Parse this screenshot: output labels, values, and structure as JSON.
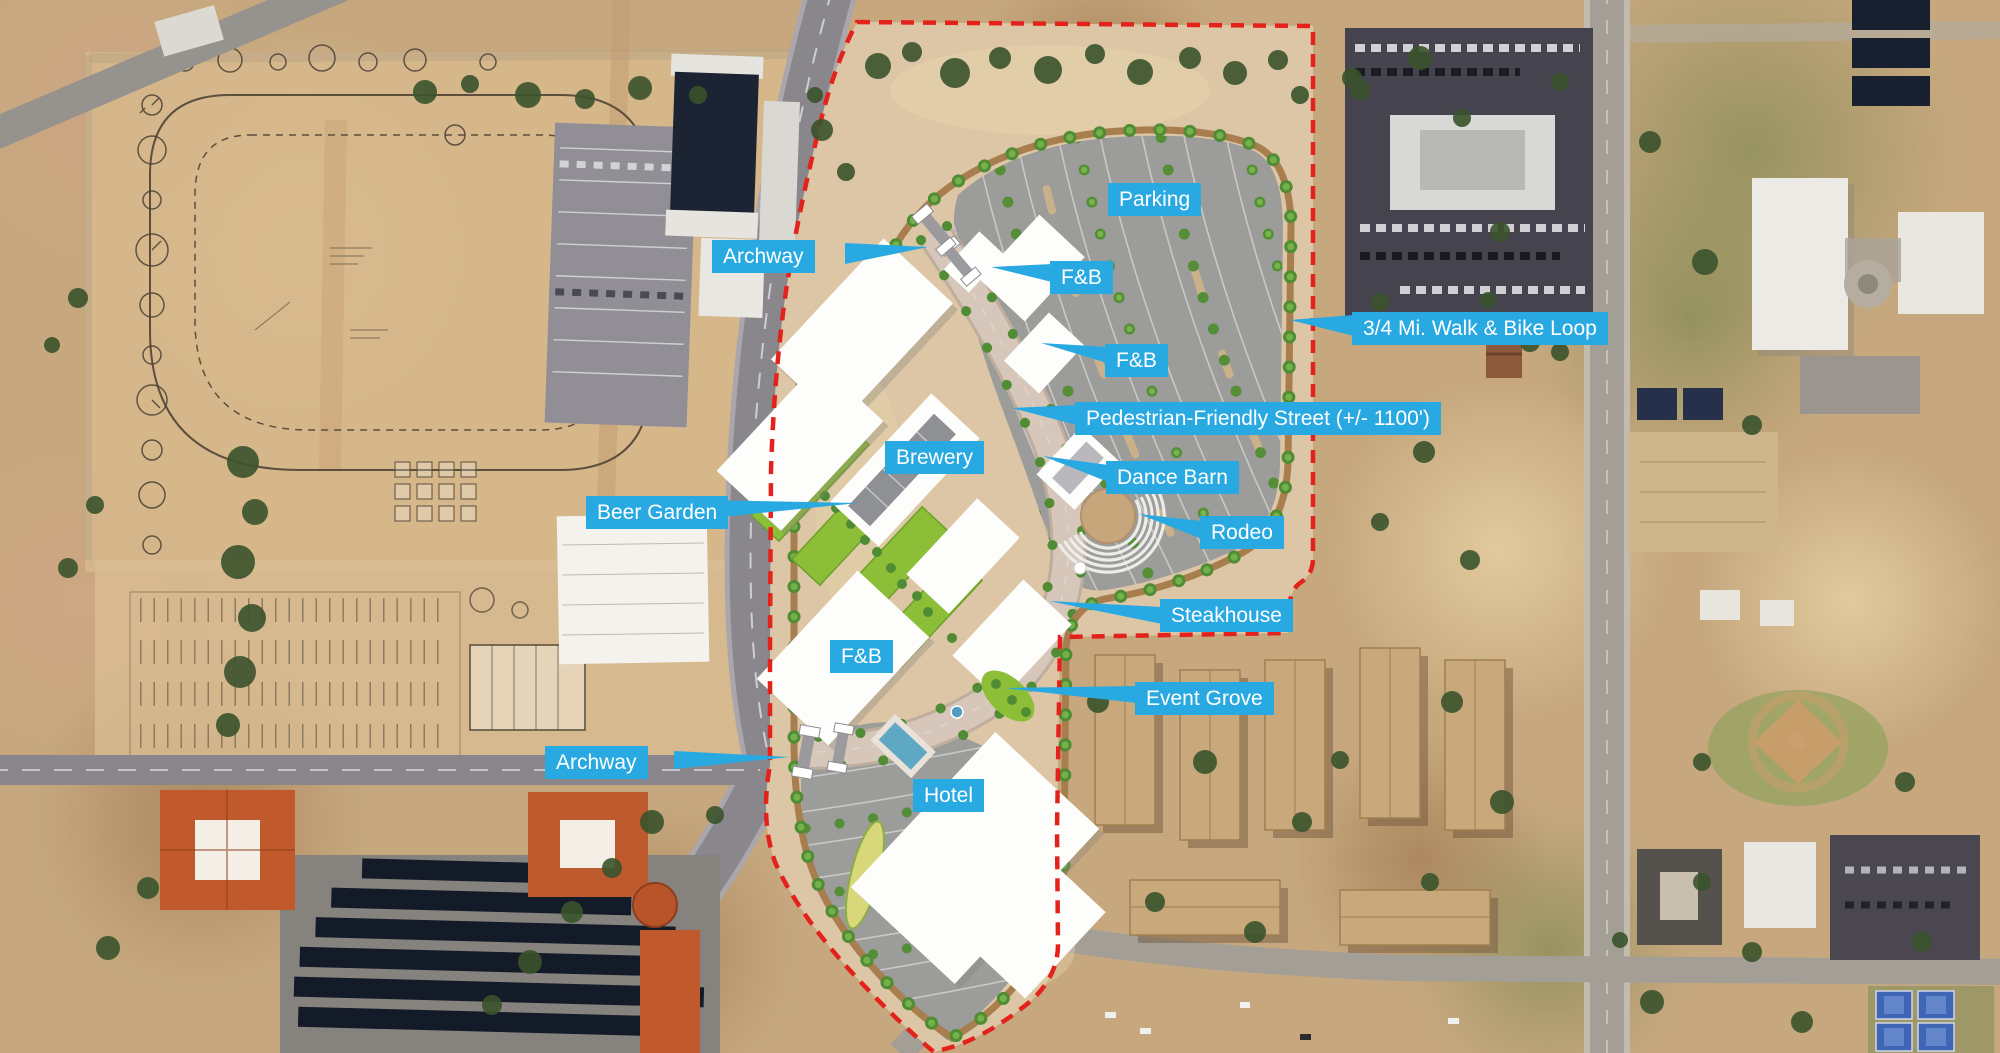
{
  "map": {
    "label_background": "#29a9e1",
    "label_text_color": "#ffffff",
    "site_boundary_color": "#e4221c",
    "walk_loop_color": "#a87e4e",
    "labels": {
      "parking": "Parking",
      "archway_north": "Archway",
      "fb_north": "F&B",
      "fb_mid": "F&B",
      "walk_bike_loop": "3/4 Mi. Walk & Bike Loop",
      "pedestrian_street": "Pedestrian-Friendly Street (+/- 1100')",
      "brewery": "Brewery",
      "dance_barn": "Dance Barn",
      "beer_garden": "Beer Garden",
      "rodeo": "Rodeo",
      "steakhouse": "Steakhouse",
      "fb_south": "F&B",
      "event_grove": "Event Grove",
      "archway_south": "Archway",
      "hotel": "Hotel"
    }
  }
}
